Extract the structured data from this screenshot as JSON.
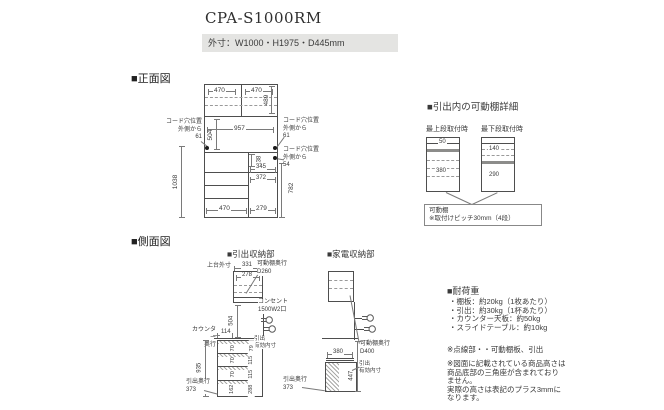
{
  "header": {
    "title": "CPA-S1000RM",
    "outer_dims": "外寸：W1000・H1975・D445mm"
  },
  "front_view": {
    "label": "■正面図",
    "dims": {
      "top_w_left": "470",
      "top_w_right": "470",
      "upper_h": "489",
      "open_w": "957",
      "open_h": "504",
      "lower_h": "1038",
      "gap_h": "138",
      "slide_w": "345",
      "inner_w": "372",
      "right_h": "782",
      "bottom_w_left": "470",
      "bottom_w_right": "279"
    },
    "cord_left": "コード穴位置\n外側から\n61",
    "cord_right_top": "コード穴位置\n外側から\n61",
    "cord_right_bottom": "コード穴位置\n外側から\n54"
  },
  "shelf_detail": {
    "label": "■引出内の可動棚詳細",
    "top_mount_label": "最上段取付時",
    "bottom_mount_label": "最下段取付時",
    "top_mount": {
      "above": "50",
      "below": "380"
    },
    "bottom_mount": {
      "above": "140",
      "below": "290"
    },
    "note": "可動棚\n※取付けピッチ30mm（4段）"
  },
  "side_view": {
    "label": "■側面図",
    "drawer_unit": {
      "label": "■引出収納部",
      "upper_outer_label": "上台外寸",
      "upper_w": "331",
      "upper_inner_w": "278",
      "shelf_depth": "可動棚奥行\nD260",
      "open_h": "504",
      "outlet_label": "コンセント\n1500W2口",
      "counter_label": "カウンター\n奥行",
      "counter_front": "114",
      "inner_label": "引出\n有効内寸",
      "inner_heights": [
        "70",
        "70",
        "70",
        "162"
      ],
      "opening_heights": [
        "79",
        "115",
        "115",
        "288"
      ],
      "total_h": "935",
      "drawer_depth": "引出奥行\n373"
    },
    "appliance_unit": {
      "label": "■家電収納部",
      "slide_depth": "380",
      "shelf_depth": "可動棚奥行\nD400",
      "inner_label": "引出\n有効内寸",
      "inner_h": "447",
      "drawer_depth": "引出奥行\n373"
    }
  },
  "notes": {
    "load_title": "■耐荷重",
    "load_items": [
      "・棚板：約20kg（1枚あたり）",
      "・引出：約30kg（1杯あたり）",
      "・カウンター天板：約50kg",
      "・スライドテーブル：約10kg"
    ],
    "dotted_note": "※点線部・・可動棚板、引出",
    "remark": "※図面に記載されている商品高さは\n商品底部の三角座が含まれており\nません。\n実際の高さは表記のプラス3mmに\nなります。"
  }
}
